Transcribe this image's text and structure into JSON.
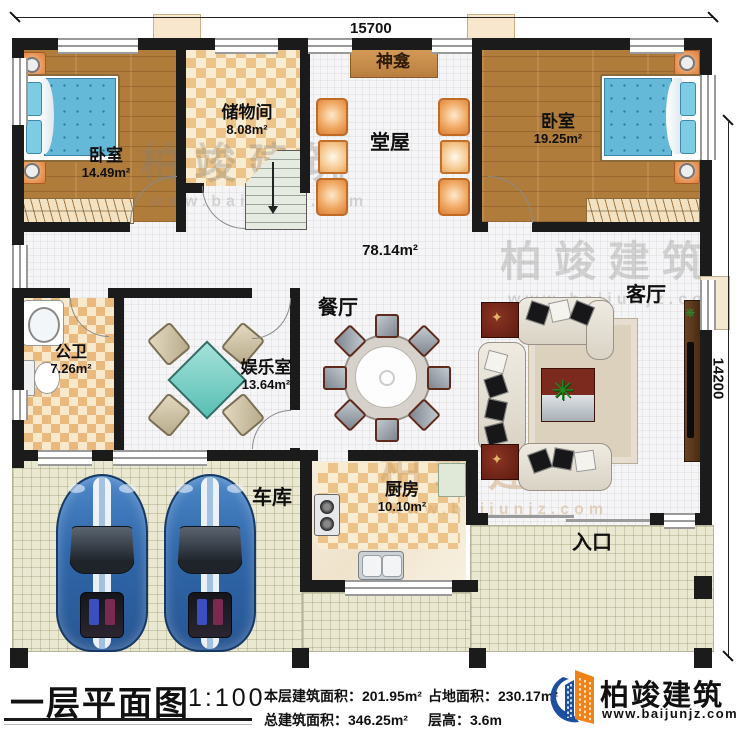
{
  "plan": {
    "dimensions": {
      "width_label": "15700",
      "height_label": "14200"
    },
    "rooms": {
      "bedroom_left": {
        "name": "卧室",
        "area": "14.49m²"
      },
      "storage": {
        "name": "储物间",
        "area": "8.08m²"
      },
      "shrine": {
        "name": "神龛"
      },
      "hall": {
        "name": "堂屋"
      },
      "bedroom_right": {
        "name": "卧室",
        "area": "19.25m²"
      },
      "open_area": {
        "area": "78.14m²"
      },
      "bathroom": {
        "name": "公卫",
        "area": "7.26m²"
      },
      "game_room": {
        "name": "娱乐室",
        "area": "13.64m²"
      },
      "dining_room": {
        "name": "餐厅"
      },
      "living_room": {
        "name": "客厅"
      },
      "kitchen": {
        "name": "厨房",
        "area": "10.10m²"
      },
      "garage": {
        "name": "车库"
      },
      "entrance": {
        "name": "入口"
      }
    },
    "watermark": {
      "brand": "柏竣建筑",
      "site": "www.baijunjz.com"
    }
  },
  "footer": {
    "title": "一层平面图",
    "scale": "1:100",
    "stats": [
      {
        "label": "本层建筑面积：",
        "value": "201.95m²"
      },
      {
        "label": "占地面积：",
        "value": "230.17m²"
      },
      {
        "label": "总建筑面积：",
        "value": "346.25m²"
      },
      {
        "label": "层高：",
        "value": "3.6m"
      }
    ],
    "brand": {
      "name": "柏竣建筑",
      "site": "www.baijunjz.com"
    }
  },
  "colors": {
    "wall": "#1b1b1b",
    "accent_orange": "#f08218",
    "accent_blue": "#1c4f9f"
  }
}
